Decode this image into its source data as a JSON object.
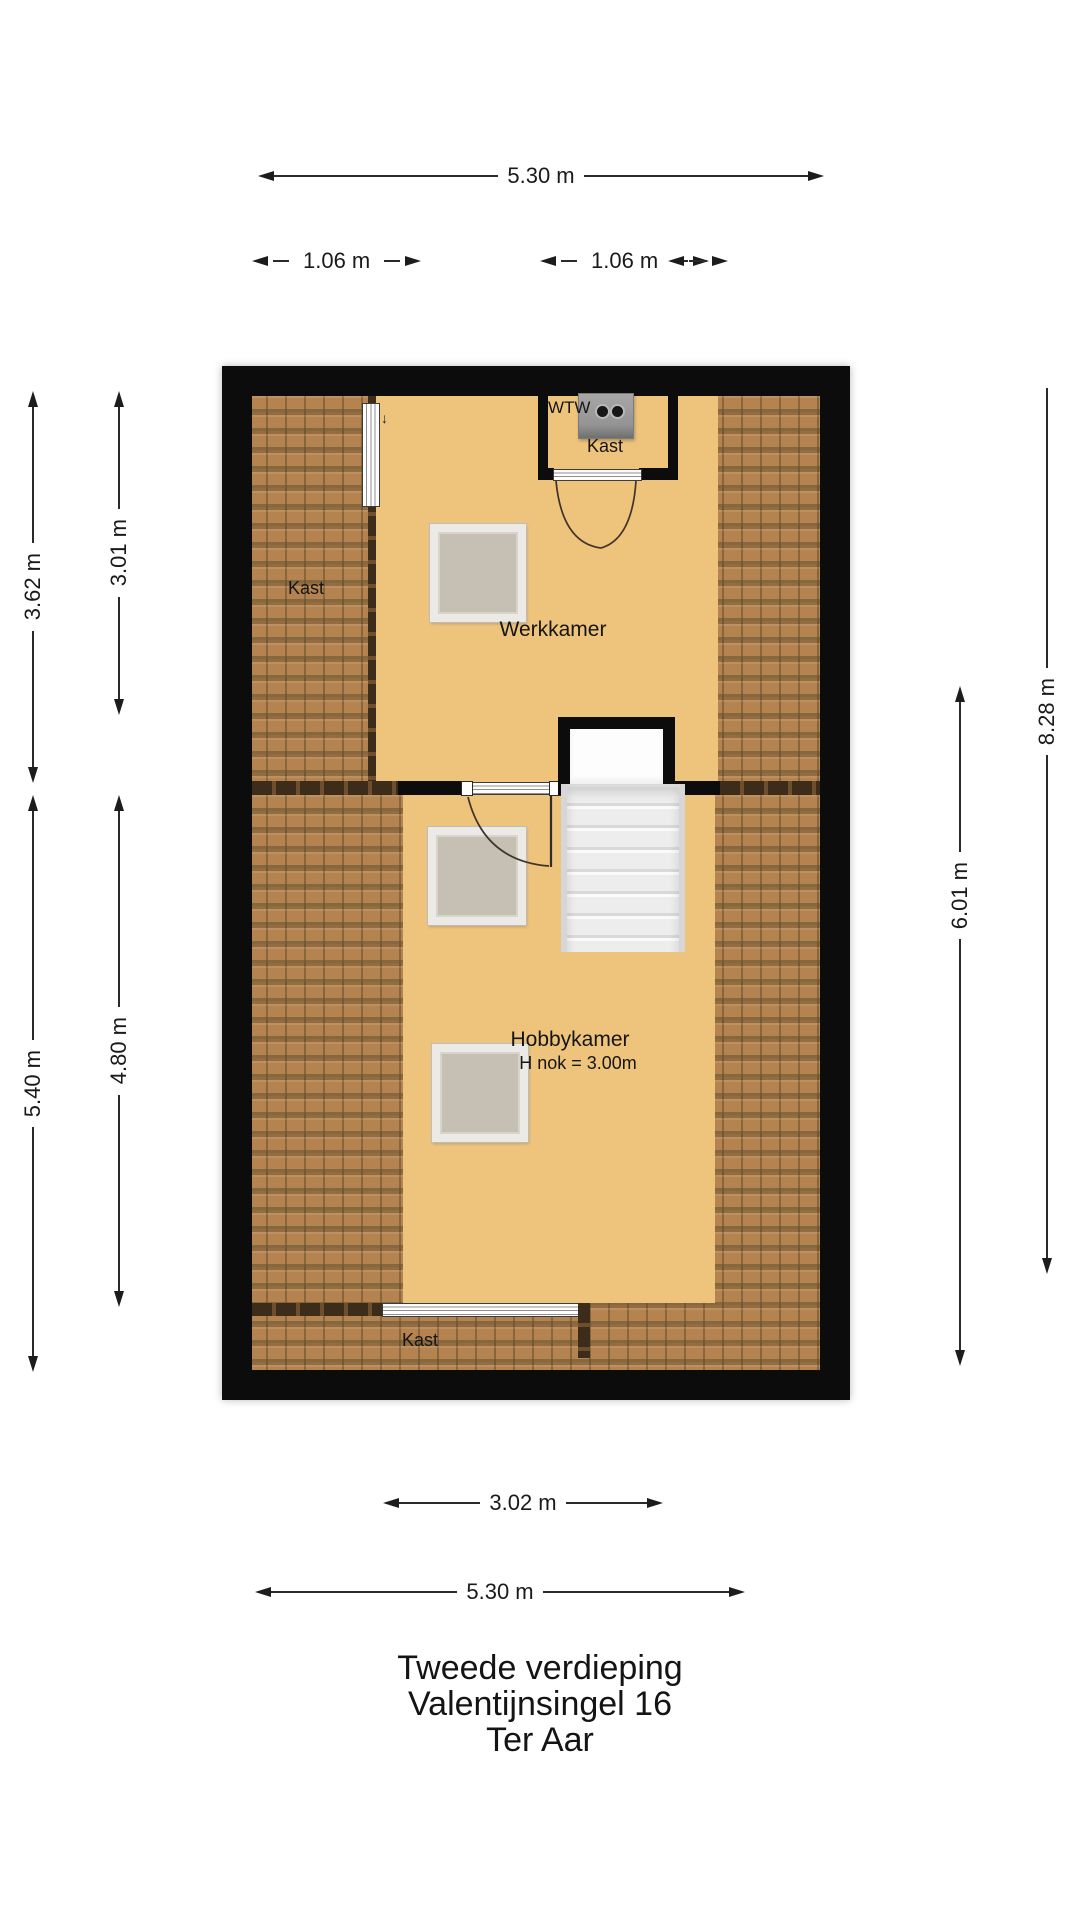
{
  "title": {
    "line1": "Tweede verdieping",
    "line2": "Valentijnsingel 16",
    "line3": "Ter Aar"
  },
  "rooms": {
    "werkkamer": {
      "name": "Werkkamer"
    },
    "hobbykamer": {
      "name": "Hobbykamer",
      "ridge_height": "H nok = 3.00m"
    },
    "kast_left": {
      "name": "Kast"
    },
    "kast_top": {
      "name": "Kast"
    },
    "kast_bottom": {
      "name": "Kast"
    },
    "wtw_unit": {
      "name": "WTW"
    }
  },
  "dimensions": {
    "top_width": "5.30 m",
    "top_left_strip": "1.06 m",
    "top_right_strip": "1.06 m",
    "left_upper_outer": "3.62 m",
    "left_upper_inner": "3.01 m",
    "left_lower_outer": "5.40 m",
    "left_lower_inner": "4.80 m",
    "right_outer": "8.28 m",
    "right_inner": "6.01 m",
    "bottom_kast": "3.02 m",
    "bottom_width": "5.30 m"
  },
  "colors": {
    "floor": "#eec47d",
    "roof_tiles": "#b5834f",
    "walls": "#0c0c0c",
    "skylight": "#c6c0b4",
    "stairs": "#ededed"
  }
}
